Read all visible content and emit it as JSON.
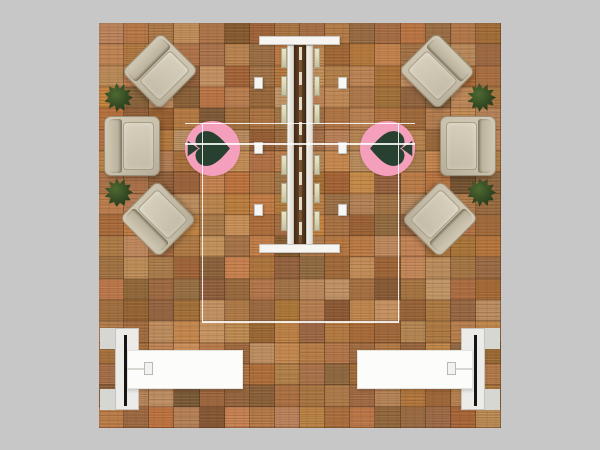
{
  "scene": {
    "description": "top-down render of an exhibit booth floor plan",
    "background_color": "#c7c7c7",
    "floor": {
      "material": "wood-plank-tiles",
      "base_color": "#ab7b4c",
      "grid_cols": 16,
      "grid_rows": 19
    }
  },
  "palette": {
    "rug_pink": "#f49fbc",
    "logo_green": "#274030",
    "plant_green": "#2c401f",
    "chair_beige": "#c9c1ac",
    "structure_white": "#f6f5f1",
    "counter_white": "#fcfcfb",
    "monitor_black": "#151515",
    "post_gray": "#d6d6d3",
    "shelf_tan": "#ddd8b4"
  },
  "furniture": {
    "armchairs": [
      {
        "id": "armchair-top-left"
      },
      {
        "id": "armchair-mid-left"
      },
      {
        "id": "armchair-bottom-left"
      },
      {
        "id": "armchair-top-right"
      },
      {
        "id": "armchair-mid-right"
      },
      {
        "id": "armchair-bottom-right"
      }
    ],
    "planters": [
      {
        "id": "planter-left-upper"
      },
      {
        "id": "planter-left-lower"
      },
      {
        "id": "planter-right-upper"
      },
      {
        "id": "planter-right-lower"
      }
    ],
    "rugs": [
      {
        "id": "rug-left",
        "logo": "heart-play-logo"
      },
      {
        "id": "rug-right",
        "logo": "heart-play-logo-mirrored"
      }
    ],
    "center_display": {
      "id": "center-display-wall",
      "shelves_per_side": 6,
      "stools_per_side": 3
    },
    "counters": [
      {
        "id": "counter-left",
        "has_monitor": true
      },
      {
        "id": "counter-right",
        "has_monitor": true
      }
    ],
    "hanging_sign": {
      "id": "hanging-sign-outline"
    }
  }
}
